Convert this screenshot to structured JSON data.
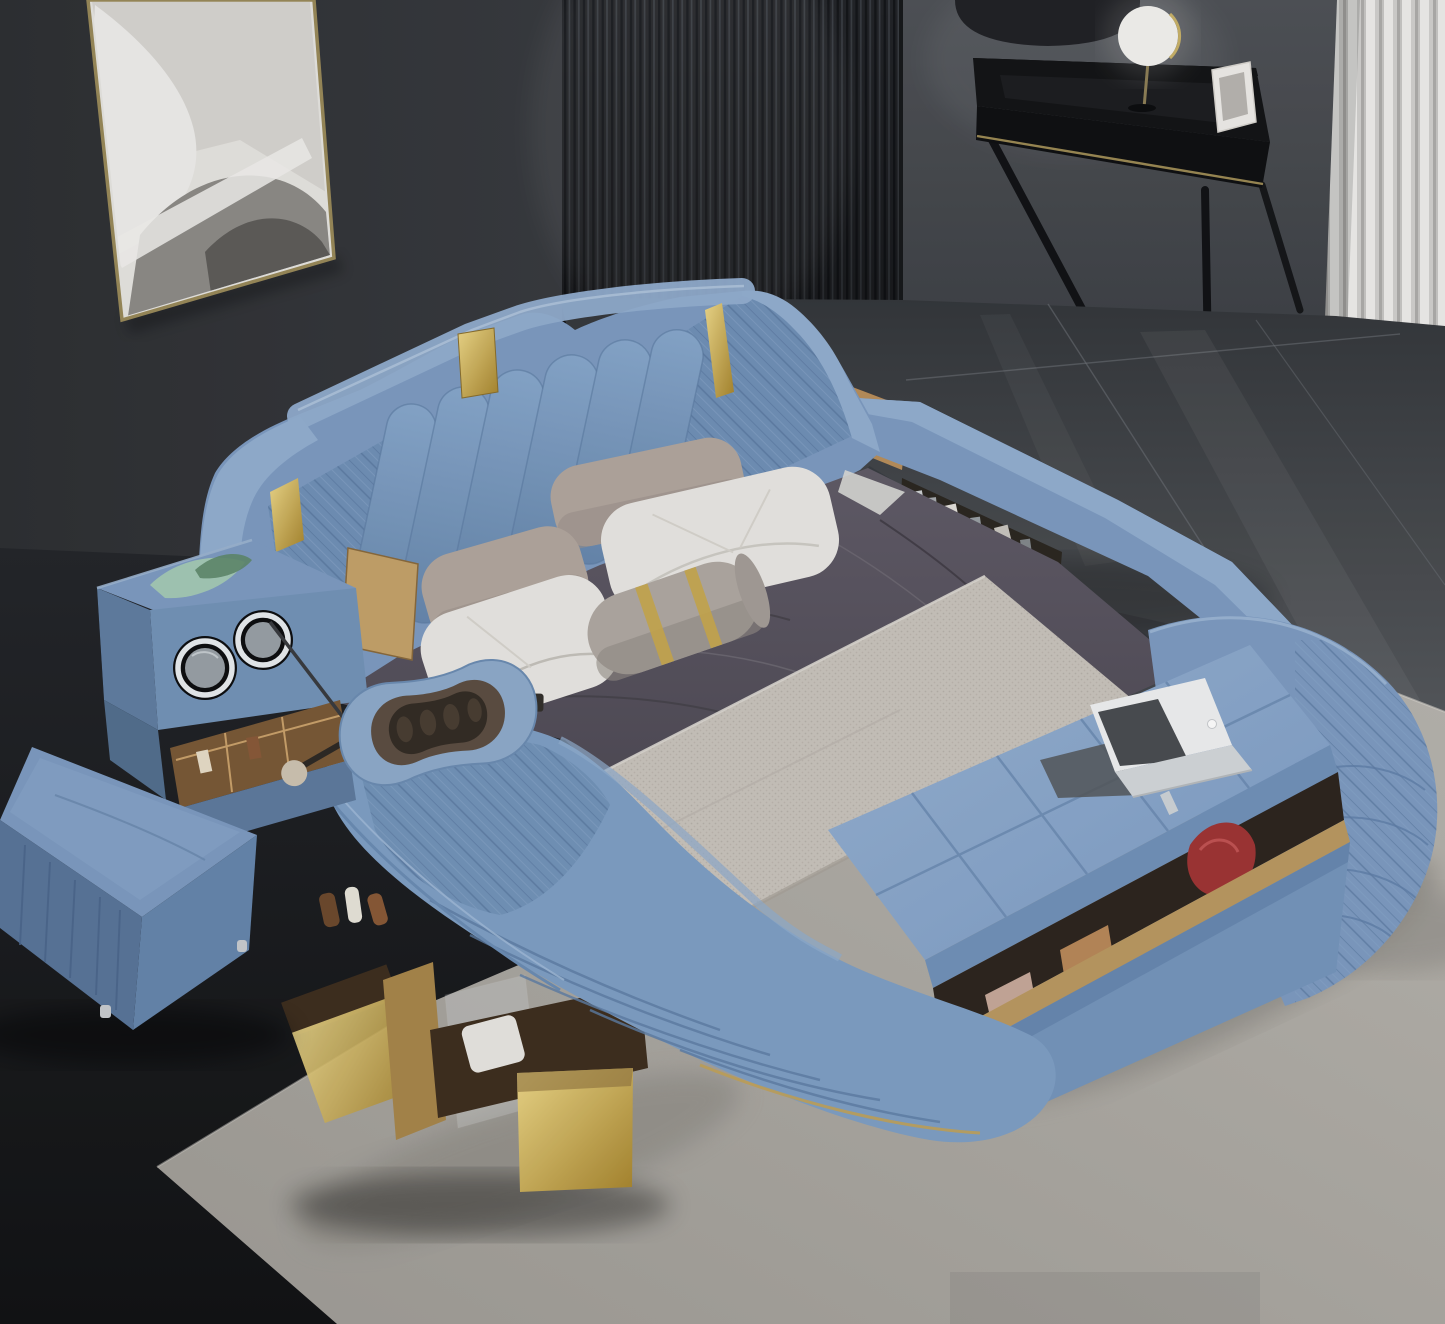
{
  "image": {
    "type": "photograph",
    "subject": "Blue leather multifunctional smart bed with integrated massage lounger, speakers and storage",
    "setting": "Modern bedroom with dark gray walls, slatted wood panel, vanity desk, curtain, tiled floor and light area rug"
  },
  "palette": {
    "wall-dark": "#3a3d42",
    "wall-left-edge": "#2e3034",
    "wall-right": "#4b4e53",
    "slat-dark": "#202226",
    "slat-line": "#43474e",
    "curtain-light": "#efeeec",
    "curtain-mid": "#d2d1cf",
    "curtain-dark": "#aeadab",
    "desk-black": "#141517",
    "trim-gold": "#9c8a55",
    "mirror-face": "#f4f3f0",
    "frame-gold": "#9a8a5a",
    "art-bg": "#e7e5e1",
    "tile-top": "#35383c",
    "tile-bottom": "#54575b",
    "tile-seam": "#70747a",
    "floor-dark": "#17181b",
    "rug": "#aca9a3",
    "rug-light": "#b8b5af",
    "rug-shadow": "#8b8882",
    "bed-blue": "#7e9cc2",
    "bed-blue-light": "#93afd1",
    "bed-blue-lighter": "#a9c2dc",
    "bed-blue-dark": "#6685ac",
    "bed-blue-deep": "#54719a",
    "quilt-line": "#5d7ca3",
    "gold": "#c9a84e",
    "gold-light": "#e8d27c",
    "sheet": "#585460",
    "sheet-dark": "#46424b",
    "sheet-light": "#6e6873",
    "runner": "#c9c4bd",
    "runner-dot": "#b3ada5",
    "pillow-white": "#eae8e4",
    "pillow-shade": "#cfccc6",
    "pillow-taupe": "#b2a79f",
    "bolster": "#b0a9a3",
    "wood": "#b98f5c",
    "wood-dark": "#7a5a36",
    "wood-deep": "#3f2f20",
    "drawer-gold": "#bb9a62",
    "red-item": "#a03636",
    "speaker-rim": "#e9edf0",
    "speaker-face": "#9aa1a7",
    "glass-green": "#a9ceb6",
    "glass-green-dark": "#5f8a6d",
    "laptop-white": "#f0f1f2",
    "laptop-gray": "#55585c",
    "massager-ring": "#8fabcb",
    "massager-inner": "#5d4f43",
    "massager-deep": "#352d26",
    "knob": "#cfc4b2"
  },
  "scene": {
    "objects": {
      "wall": {
        "label": "dark gray bedroom wall"
      },
      "slat_panel": {
        "label": "dark vertical wood slat accent panel behind bed"
      },
      "artwork": {
        "label": "gold framed abstract black and white artwork"
      },
      "pendant_lamp": {
        "label": "dark pendant lamp shade"
      },
      "vanity_desk": {
        "label": "black vanity desk with gold trim and splayed legs"
      },
      "vanity_mirror": {
        "label": "round lighted makeup mirror on desk"
      },
      "desk_frame": {
        "label": "small white frame on desk"
      },
      "curtain": {
        "label": "white pleated floor curtain"
      },
      "floor_tiles": {
        "label": "dark glossy tile floor"
      },
      "floor_dark": {
        "label": "dark shadowed floor at left"
      },
      "rug": {
        "label": "light gray area rug under bed"
      },
      "bed": {
        "label": "blue leather multifunctional smart bed"
      },
      "headboard": {
        "label": "winged headboard with channel tufting, diamond quilting and gold accents"
      },
      "side_rail": {
        "label": "angular side rail with open bookshelf and storage tray"
      },
      "mattress": {
        "label": "mattress with dark gray sheet"
      },
      "runner": {
        "label": "textured light bed runner"
      },
      "pillows": {
        "label": "white and taupe pillows with gray bolster"
      },
      "bench": {
        "label": "tufted foot bench with open storage"
      },
      "laptop": {
        "label": "open laptop on foot bench"
      },
      "chaise": {
        "label": "integrated massage lounger"
      },
      "eye_massager": {
        "label": "eye massager on lounger headrest"
      },
      "drawers": {
        "label": "open wooden storage drawers"
      },
      "speaker_console": {
        "label": "side console with twin speakers and organizer"
      },
      "ottoman": {
        "label": "blue leather ottoman stool"
      }
    }
  }
}
